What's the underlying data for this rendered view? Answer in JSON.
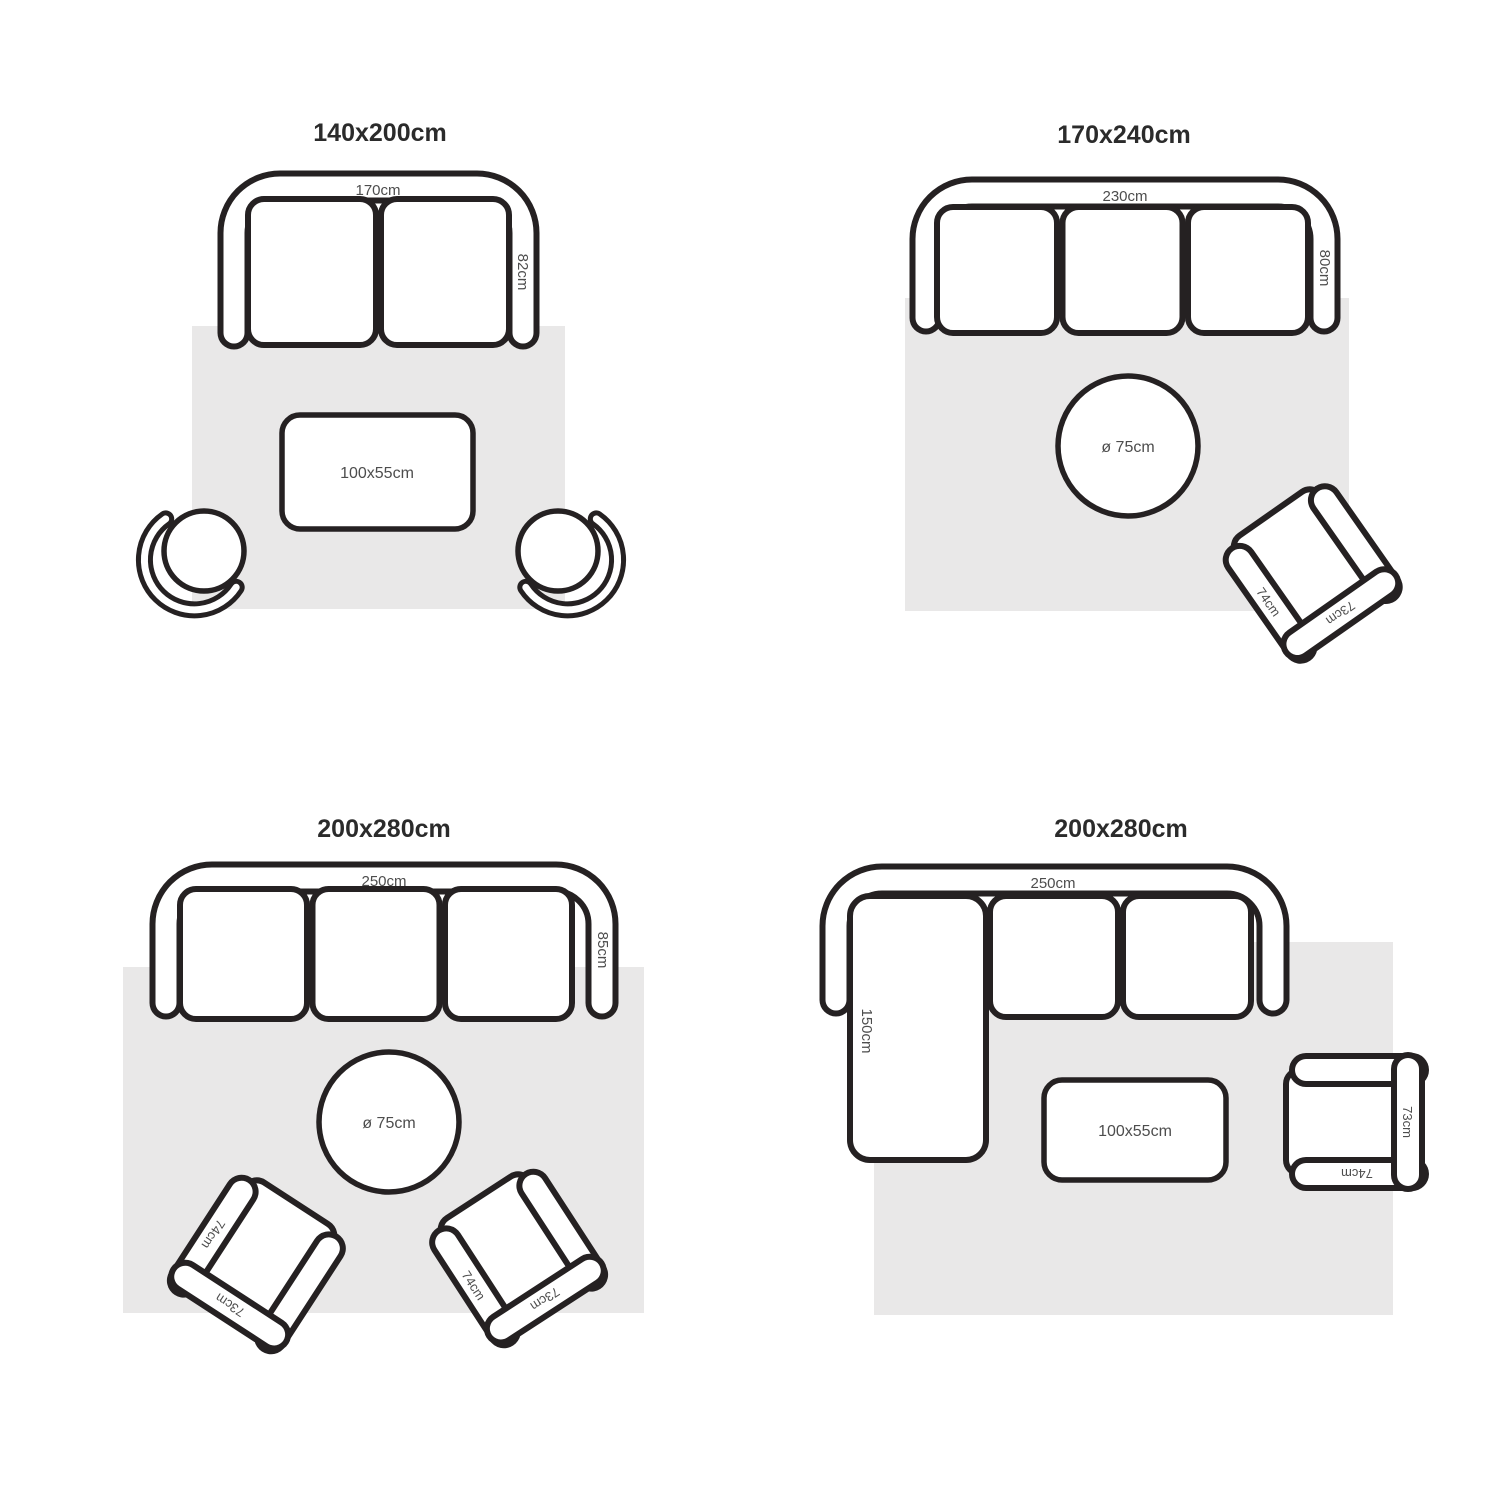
{
  "colors": {
    "outline": "#252122",
    "rug_fill": "#e9e8e8",
    "title_text": "#2b2b2b",
    "label_text": "#4d4d4d",
    "background": "#ffffff"
  },
  "panels": [
    {
      "title": "140x200cm",
      "sofa": {
        "seats": 2,
        "width_label": "170cm",
        "depth_label": "82cm"
      },
      "table": {
        "shape": "rectangle",
        "label": "100x55cm"
      },
      "chairs": [
        {
          "type": "tub-chair"
        },
        {
          "type": "tub-chair"
        }
      ]
    },
    {
      "title": "170x240cm",
      "sofa": {
        "seats": 3,
        "width_label": "230cm",
        "depth_label": "80cm"
      },
      "table": {
        "shape": "round",
        "label": "ø 75cm"
      },
      "chair": {
        "type": "armchair",
        "arm_label": "74cm",
        "back_label": "73cm"
      }
    },
    {
      "title": "200x280cm",
      "sofa": {
        "seats": 3,
        "width_label": "250cm",
        "depth_label": "85cm"
      },
      "table": {
        "shape": "round",
        "label": "ø 75cm"
      },
      "chairs": [
        {
          "type": "armchair",
          "arm_label": "74cm",
          "back_label": "73cm"
        },
        {
          "type": "armchair",
          "arm_label": "74cm",
          "back_label": "73cm"
        }
      ]
    },
    {
      "title": "200x280cm",
      "sofa": {
        "seats": 2,
        "width_label": "250cm",
        "chaise_label": "150cm"
      },
      "table": {
        "shape": "rectangle",
        "label": "100x55cm"
      },
      "chair": {
        "type": "armchair",
        "arm_label": "74cm",
        "back_label": "73cm"
      }
    }
  ]
}
